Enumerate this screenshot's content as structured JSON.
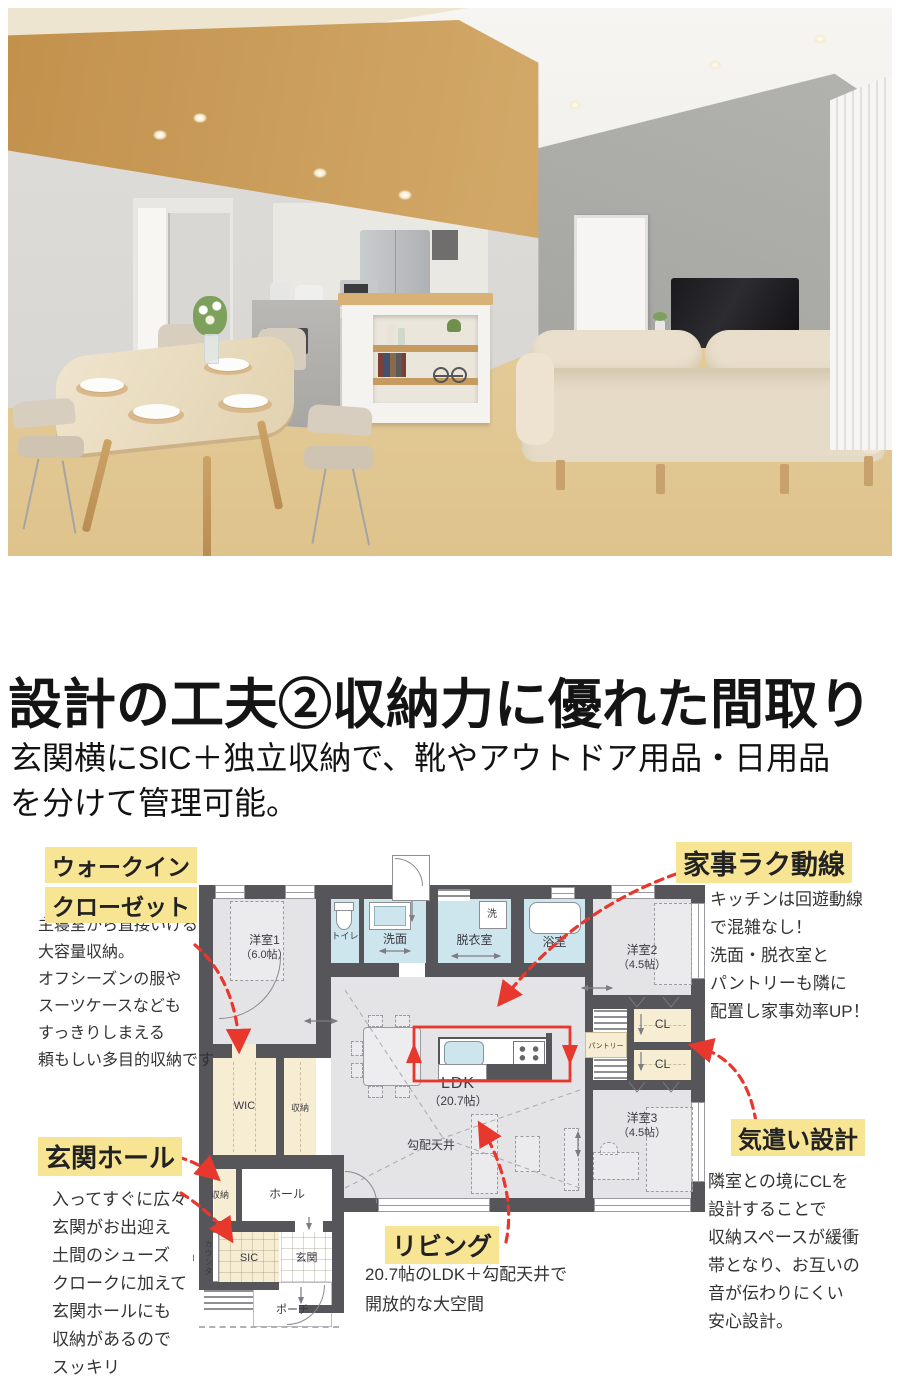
{
  "headline": {
    "title": "設計の工夫②収納力に優れた間取り",
    "subtitle": [
      "玄関横にSIC＋独立収納で、靴やアウトドア用品・日用品",
      "を分けて管理可能。"
    ]
  },
  "annotations": {
    "walkin": {
      "label": [
        "ウォークイン",
        "クローゼット"
      ],
      "body": [
        "主寝室から直接いける",
        "大容量収納。",
        "オフシーズンの服や",
        "スーツケースなども",
        "すっきりしまえる",
        "頼もしい多目的収納です"
      ]
    },
    "kaji": {
      "label": "家事ラク動線",
      "body": [
        "キッチンは回遊動線",
        "で混雑なし！",
        "洗面・脱衣室と",
        "パントリーも隣に",
        "配置し家事効率UP！"
      ]
    },
    "genkan": {
      "label": "玄関ホール",
      "body": [
        "入ってすぐに広々",
        "玄関がお出迎え",
        "土間のシューズ",
        "クロークに加えて",
        "玄関ホールにも",
        "収納があるので",
        "スッキリ"
      ]
    },
    "living": {
      "label": "リビング",
      "body": [
        "20.7帖のLDK＋勾配天井で",
        "開放的な大空間"
      ]
    },
    "kizukai": {
      "label": "気遣い設計",
      "body": [
        "隣室との境にCLを",
        "設計することで",
        "収納スペースが緩衝",
        "帯となり、お互いの",
        "音が伝わりにくい",
        "安心設計。"
      ]
    }
  },
  "floorplan": {
    "rooms": {
      "yoshitsu1": "洋室1",
      "yoshitsu1_size": "（6.0帖）",
      "toilet": "トイレ",
      "senmen": "洗面",
      "washer": "洗",
      "datsuishitsu": "脱衣室",
      "yokushitsu": "浴室",
      "yoshitsu2": "洋室2",
      "yoshitsu2_size": "（4.5帖）",
      "pantry": "パントリー",
      "cl_upper": "CL",
      "cl_lower": "CL",
      "wic": "WIC",
      "shuno_wic": "収納",
      "ldk": "LDK",
      "ldk_size": "（20.7帖）",
      "koubai_tenjo": "勾配天井",
      "yoshitsu3": "洋室3",
      "yoshitsu3_size": "（4.5帖）",
      "shuno_hall": "収納",
      "hall": "ホール",
      "counter": "カウンター",
      "sic": "SIC",
      "genkan": "玄関",
      "porch": "ポーチ"
    },
    "colors": {
      "wall": "#55555a",
      "room_gray": "#e4e4e7",
      "wet_blue": "#cde6ee",
      "cream": "#f6edd3",
      "highlight_yellow": "#f7e594",
      "arrow_red": "#e8372d"
    }
  }
}
